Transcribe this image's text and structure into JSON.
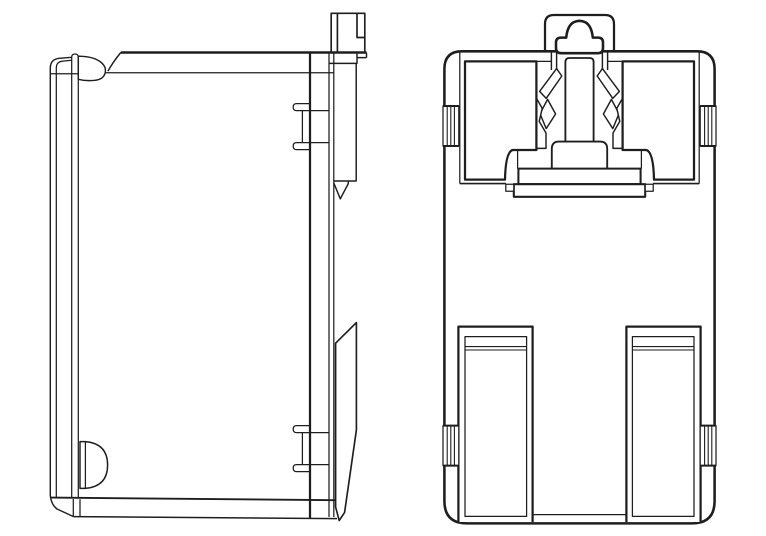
{
  "page": {
    "background": "#ffffff",
    "width": 766,
    "height": 536
  },
  "drawing": {
    "type": "technical-line-drawing",
    "stroke_color": "#1e1e1e",
    "fill_color": "#ffffff",
    "title": "DIN-rail enclosure, two orthographic views",
    "views": [
      {
        "id": "side-view",
        "label": "Side profile view"
      },
      {
        "id": "rear-view",
        "label": "Rear view with DIN-rail mounting clip"
      }
    ],
    "parts": {
      "side": [
        "front-panel",
        "top-bump",
        "rear-wall",
        "grip-tab-top",
        "grip-tab-bottom",
        "slider-tab",
        "rail-hook",
        "d-notch"
      ],
      "rear": [
        "body-shell",
        "release-tab",
        "latch-hat",
        "latch-column",
        "spring-arm-left",
        "spring-arm-right",
        "clip-foot",
        "recess-left",
        "recess-right",
        "grip-tab-x4",
        "foot-left",
        "foot-right"
      ]
    }
  }
}
